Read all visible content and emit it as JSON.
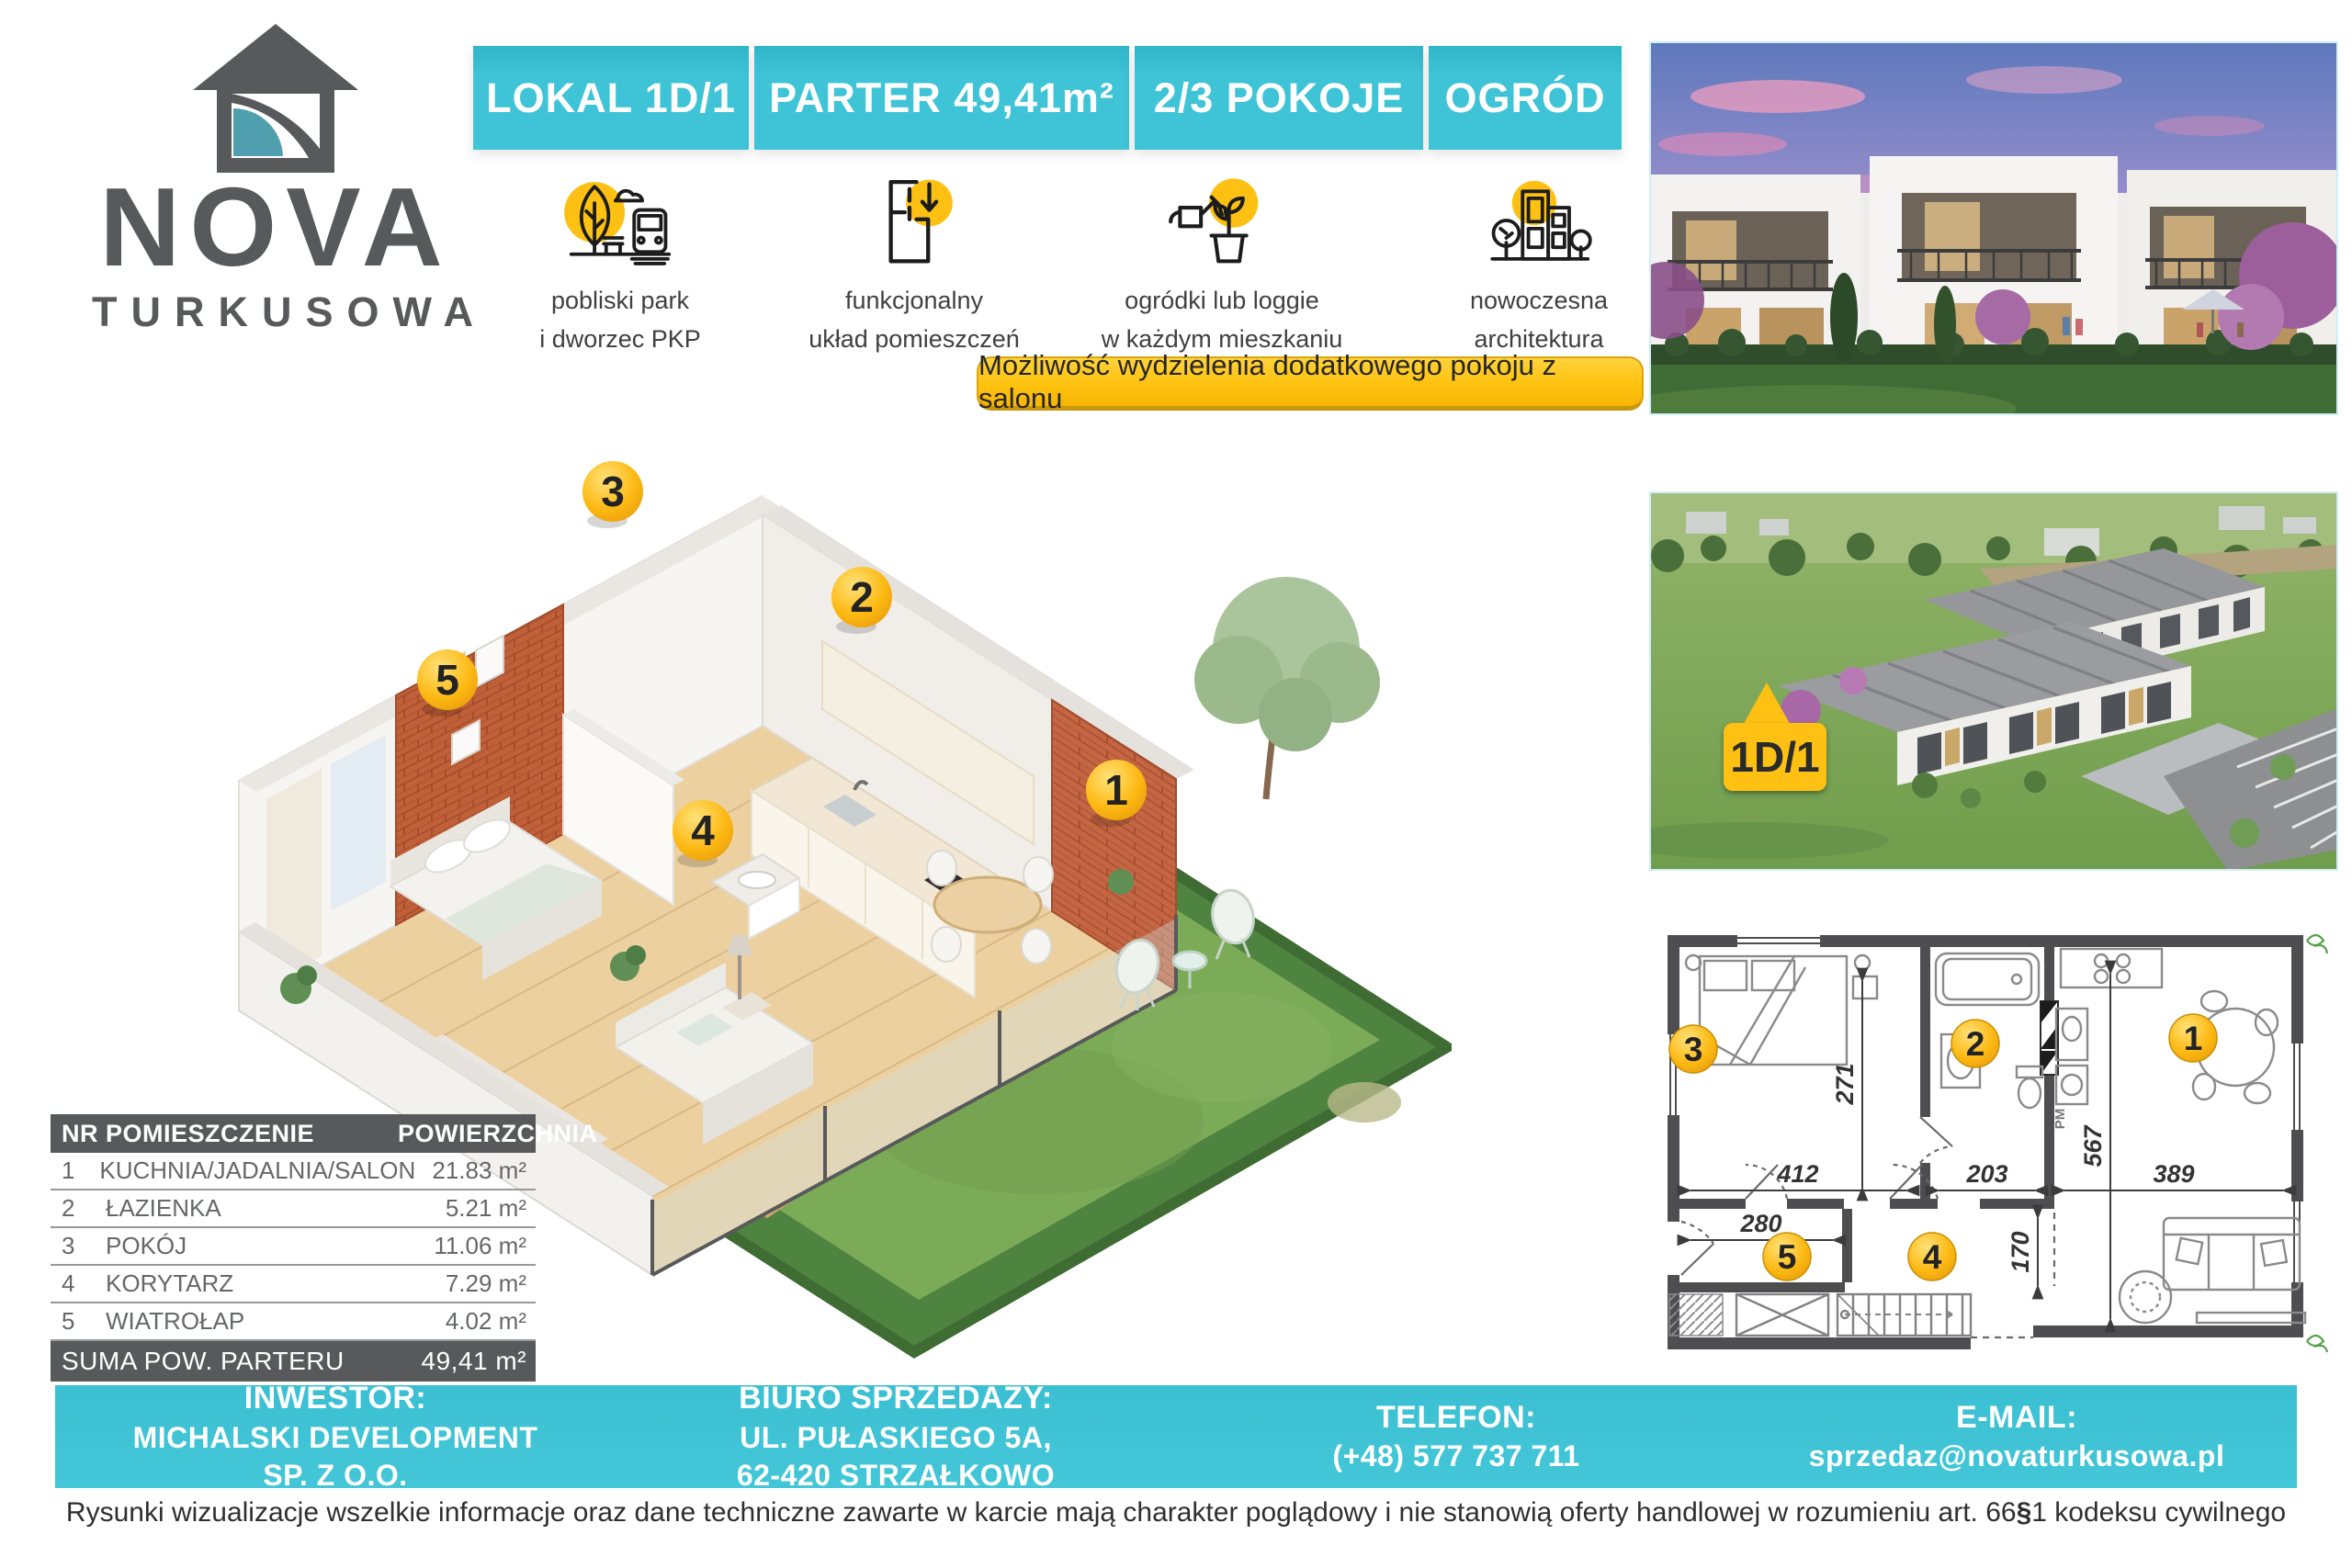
{
  "brand": {
    "name": "NOVA",
    "subtitle": "TURKUSOWA"
  },
  "header": {
    "segments": [
      "LOKAL 1D/1",
      "PARTER 49,41m²",
      "2/3 POKOJE",
      "OGRÓD"
    ]
  },
  "features": [
    {
      "icon": "park-and-train-icon",
      "line1": "pobliski park",
      "line2": "i dworzec PKP"
    },
    {
      "icon": "floorplan-arrow-icon",
      "line1": "funkcjonalny",
      "line2": "układ pomieszczeń"
    },
    {
      "icon": "watering-plant-icon",
      "line1": "ogródki lub loggie",
      "line2": "w każdym mieszkaniu"
    },
    {
      "icon": "modern-buildings-icon",
      "line1": "nowoczesna",
      "line2": "architektura"
    }
  ],
  "banner": {
    "text": "Możliwość wydzielenia dodatkowego pokoju z salonu"
  },
  "photo2": {
    "callout": "1D/1"
  },
  "badges": {
    "b1": "1",
    "b2": "2",
    "b3": "3",
    "b4": "4",
    "b5": "5"
  },
  "plan2d": {
    "dims": {
      "d412": "412",
      "d203": "203",
      "d389": "389",
      "d280": "280",
      "d271": "271",
      "d567": "567",
      "d170": "170"
    },
    "pm_label": "PM"
  },
  "room_table": {
    "headers": {
      "nr": "NR",
      "room": "POMIESZCZENIE",
      "area": "POWIERZCHNIA"
    },
    "rows": [
      {
        "nr": "1",
        "room": "KUCHNIA/JADALNIA/SALON",
        "area": "21.83 m²"
      },
      {
        "nr": "2",
        "room": "ŁAZIENKA",
        "area": "5.21 m²"
      },
      {
        "nr": "3",
        "room": "POKÓJ",
        "area": "11.06 m²"
      },
      {
        "nr": "4",
        "room": "KORYTARZ",
        "area": "7.29 m²"
      },
      {
        "nr": "5",
        "room": "WIATROŁAP",
        "area": "4.02 m²"
      }
    ],
    "sum_label": "SUMA POW. PARTERU",
    "sum_area": "49,41 m²"
  },
  "contact": {
    "investor_label": "INWESTOR:",
    "investor_line1": "MICHALSKI DEVELOPMENT",
    "investor_line2": "SP. Z O.O.",
    "office_label": "BIURO SPRZEDAZY:",
    "office_line1": "UL. PUŁASKIEGO 5A,",
    "office_line2": "62-420 STRZAŁKOWO",
    "phone_label": "TELEFON:",
    "phone_value": "(+48) 577 737 711",
    "email_label": "E-MAIL:",
    "email_value": "sprzedaz@novaturkusowa.pl"
  },
  "disclaimer": {
    "part1": "Rysunki wizualizacje wszelkie informacje oraz dane techniczne zawarte w karcie mają charakter poglądowy i nie stanowią oferty handlowej w rozumieniu art. 66",
    "section_sign": "§",
    "part2": "1 kodeksu cywilnego"
  },
  "colors": {
    "teal": "#3ec4d6",
    "yellow": "#ffc20e",
    "dark_gray": "#58595b",
    "brick": "#bf5f38"
  }
}
